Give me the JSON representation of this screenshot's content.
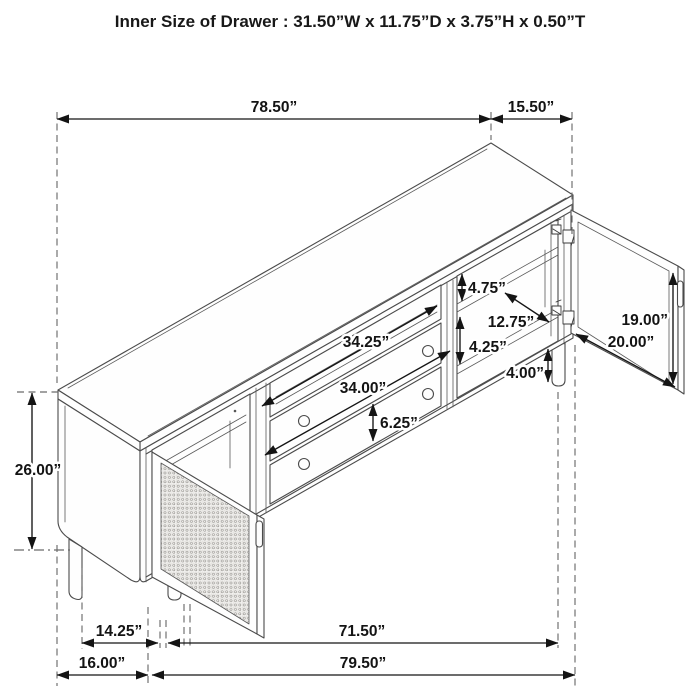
{
  "title": "Inner Size of Drawer : 31.50”W x 11.75”D x 3.75”H x 0.50”T",
  "diagram": {
    "type": "furniture-dimension-drawing",
    "subject": "TV console / sideboard, isometric line drawing with open mesh door (left) and open glass door (right)"
  },
  "dims": {
    "top_length": "78.50”",
    "top_side": "15.50”",
    "opening_top_height": "4.75”",
    "inner_depth": "12.75”",
    "door_height": "19.00”",
    "door_width": "20.00”",
    "shelf_opening_width": "34.25”",
    "opening_mid_height": "4.25”",
    "drawer_width": "34.00”",
    "leg_height": "4.00”",
    "drawer_face_height": "6.25”",
    "total_height": "26.00”",
    "left_section_width": "14.25”",
    "bottom_right_span": "71.50”",
    "left_bottom_depth": "16.00”",
    "bottom_span": "79.50”"
  }
}
